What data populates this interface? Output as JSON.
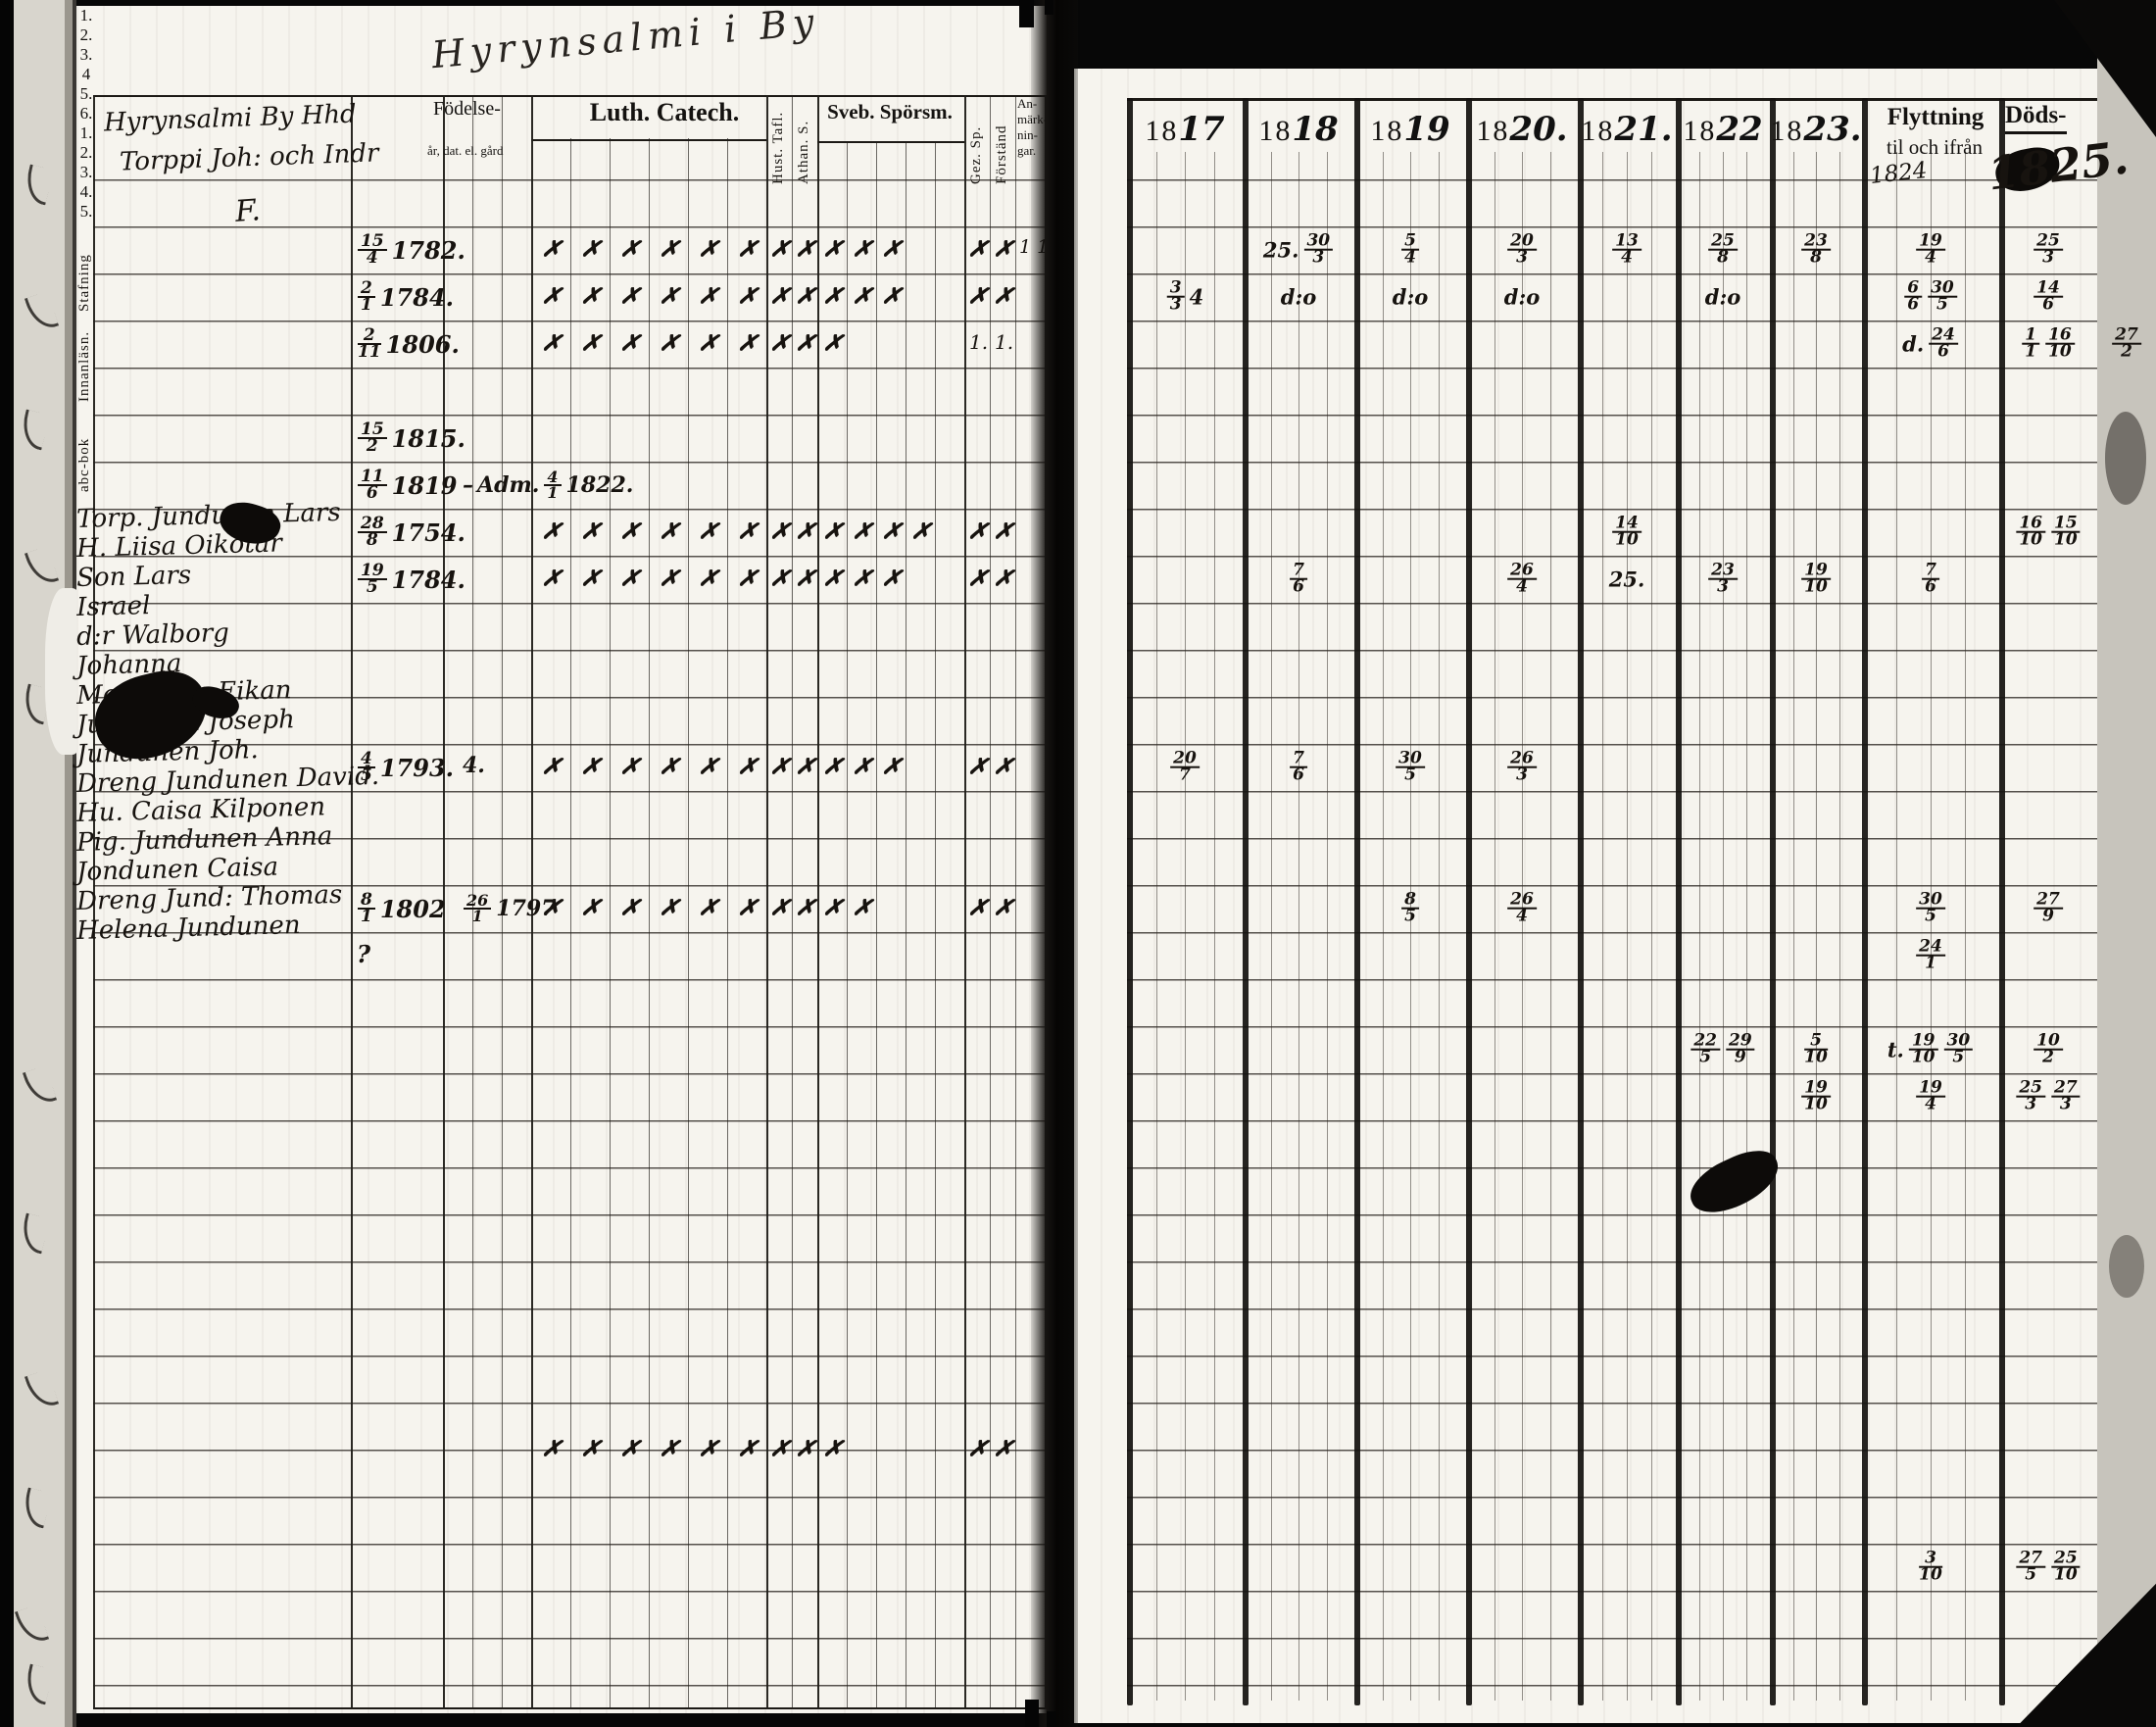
{
  "book_title_script": "Hyrynsalmi i By",
  "left_page": {
    "heading_line1": "Hyrynsalmi By Hhd",
    "heading_line2": "Torppi Joh: och Indr",
    "heading_initial": "F.",
    "header": {
      "birth_label": "Födelse-",
      "birth_sub": "år, dat. el. gård",
      "vertical_cols": [
        {
          "key": "st",
          "label": "Stafning"
        },
        {
          "key": "in",
          "label": "Innanläsn."
        },
        {
          "key": "abc",
          "label": "abc-bok"
        }
      ],
      "luth_label": "Luth. Catech.",
      "luth_numbers": [
        "1.",
        "2.",
        "3.",
        "4",
        "5.",
        "6."
      ],
      "hust_label": "Hust. Tafl.",
      "athan_label": "Athan. S.",
      "sveb_label": "Sveb. Spörsm.",
      "sveb_numbers": [
        "1.",
        "2.",
        "3.",
        "4.",
        "5."
      ],
      "gez_label": "Gez. Sp.",
      "forstand_label": "Förständ",
      "anm_lines": [
        "An-",
        "märk-",
        "nin-",
        "gar."
      ]
    },
    "rows": [
      {
        "row": 1,
        "indent": 0,
        "name": "Torp. Jundunen Lars",
        "birth": "15/4 1782.",
        "marks": [
          "l1",
          "l2",
          "l3",
          "l4",
          "l5",
          "l6",
          "ht",
          "as",
          "s1",
          "s2",
          "s3",
          "gz",
          "fs"
        ],
        "anm": "1 1"
      },
      {
        "row": 2,
        "indent": 0,
        "name": "H. Liisa Oikotar",
        "birth": "2/1 1784.",
        "marks": [
          "l1",
          "l2",
          "l3",
          "l4",
          "l5",
          "l6",
          "ht",
          "as",
          "s1",
          "s2",
          "s3",
          "gz",
          "fs"
        ]
      },
      {
        "row": 3,
        "indent": 70,
        "name": "Son Lars",
        "birth": "2/11 1806.",
        "marks": [
          "l1",
          "l2",
          "l3",
          "l4",
          "l5",
          "l6",
          "ht",
          "as",
          "s1"
        ],
        "texts": {
          "gz": "1.",
          "fs": "1."
        }
      },
      {
        "row": 4,
        "indent": 115,
        "name": "Israel",
        "birth": ""
      },
      {
        "row": 5,
        "indent": 70,
        "name": "d:r Walborg",
        "birth": "15/2 1815."
      },
      {
        "row": 6,
        "indent": 55,
        "name": "Johanna",
        "birth": "11/6 1819",
        "extra": "– Adm. 4/1 1822."
      },
      {
        "row": 7,
        "indent": 10,
        "name": "Mor Carin Eikan",
        "birth": "28/8 1754.",
        "marks": [
          "l1",
          "l2",
          "l3",
          "l4",
          "l5",
          "l6",
          "ht",
          "as",
          "s1",
          "s2",
          "s3",
          "s4",
          "gz",
          "fs"
        ]
      },
      {
        "row": 8,
        "indent": 15,
        "name": "Jundunen Joseph",
        "birth": "19/5 1784.",
        "marks": [
          "l1",
          "l2",
          "l3",
          "l4",
          "l5",
          "l6",
          "ht",
          "as",
          "s1",
          "s2",
          "s3",
          "gz",
          "fs"
        ]
      },
      {
        "row": 12,
        "indent": 25,
        "name": "Jundunen Joh.",
        "birth": "4/5 1793.",
        "extra": "4.",
        "marks": [
          "l1",
          "l2",
          "l3",
          "l4",
          "l5",
          "l6",
          "ht",
          "as",
          "s1",
          "s2",
          "s3",
          "gz",
          "fs"
        ]
      },
      {
        "row": 15,
        "indent": -20,
        "name": "Dreng Jundunen David.",
        "birth": "8/1 1802",
        "extra": "26/1 1797",
        "marks": [
          "l1",
          "l2",
          "l3",
          "l4",
          "l5",
          "l6",
          "ht",
          "as",
          "s1",
          "s2",
          "gz",
          "fs"
        ]
      },
      {
        "row": 16,
        "indent": 30,
        "name": "Hu. Caisa Kilponen",
        "birth": "?"
      },
      {
        "row": 18,
        "indent": -10,
        "name": "Pig. Jundunen Anna",
        "birth": ""
      },
      {
        "row": 19,
        "indent": 60,
        "name": "Jondunen Caisa",
        "birth": ""
      },
      {
        "row": 26.5,
        "indent": 0,
        "name": "Dreng Jund: Thomas",
        "birth": "",
        "marks": [
          "l1",
          "l2",
          "l3",
          "l4",
          "l5",
          "l6",
          "ht",
          "as",
          "s1",
          "gz",
          "fs"
        ]
      },
      {
        "row": 29,
        "indent": 40,
        "name": "Helena Jundunen",
        "birth": ""
      }
    ]
  },
  "right_page": {
    "year_cols": [
      {
        "printed": "18",
        "script": "17"
      },
      {
        "printed": "18",
        "script": "18"
      },
      {
        "printed": "18",
        "script": "19"
      },
      {
        "printed": "18",
        "script": "20."
      },
      {
        "printed": "18",
        "script": "21."
      },
      {
        "printed": "18",
        "script": "22"
      },
      {
        "printed": "18",
        "script": "23."
      }
    ],
    "flytt": {
      "line1": "Flyttning",
      "line2": "til och ifrån",
      "script": "1824"
    },
    "dods": {
      "line1": "Döds-",
      "script": "1825."
    },
    "cells": [
      {
        "row": 1,
        "col": "1818",
        "text": "25. 30/3"
      },
      {
        "row": 1,
        "col": "1819",
        "text": "5/4"
      },
      {
        "row": 1,
        "col": "1820",
        "text": "20/3"
      },
      {
        "row": 1,
        "col": "1821",
        "text": "13/4"
      },
      {
        "row": 1,
        "col": "1822",
        "text": "25/8"
      },
      {
        "row": 1,
        "col": "1823",
        "text": "23/8"
      },
      {
        "row": 1,
        "col": "fl",
        "text": "19/4."
      },
      {
        "row": 1,
        "col": "dd",
        "text": "25/3"
      },
      {
        "row": 2,
        "col": "1817",
        "text": "3/3 4"
      },
      {
        "row": 2,
        "col": "1818",
        "text": "d:o"
      },
      {
        "row": 2,
        "col": "1819",
        "text": "d:o"
      },
      {
        "row": 2,
        "col": "1820",
        "text": "d:o"
      },
      {
        "row": 2,
        "col": "1822",
        "text": "d:o"
      },
      {
        "row": 2,
        "col": "fl",
        "text": "6/6 30/5"
      },
      {
        "row": 2,
        "col": "dd",
        "text": "14/6"
      },
      {
        "row": 3,
        "col": "fl",
        "text": "d. 24/6"
      },
      {
        "row": 3,
        "col": "dd",
        "text": "1/1 16/10"
      },
      {
        "row": 3,
        "col": "mg",
        "text": "27/2"
      },
      {
        "row": 7,
        "col": "1821",
        "text": "14/10"
      },
      {
        "row": 7,
        "col": "dd",
        "text": "16/10 15/10"
      },
      {
        "row": 8,
        "col": "1818",
        "text": "7/6"
      },
      {
        "row": 8,
        "col": "1820",
        "text": "26/4"
      },
      {
        "row": 8,
        "col": "1821",
        "text": "25."
      },
      {
        "row": 8,
        "col": "1822",
        "text": "23/3"
      },
      {
        "row": 8,
        "col": "1823",
        "text": "19/10"
      },
      {
        "row": 8,
        "col": "fl",
        "text": "7/6"
      },
      {
        "row": 12,
        "col": "1817",
        "text": "20/7"
      },
      {
        "row": 12,
        "col": "1818",
        "text": "7/6"
      },
      {
        "row": 12,
        "col": "1819",
        "text": "30/5"
      },
      {
        "row": 12,
        "col": "1820",
        "text": "26/3"
      },
      {
        "row": 15,
        "col": "1819",
        "text": "8/5"
      },
      {
        "row": 15,
        "col": "1820",
        "text": "26/4"
      },
      {
        "row": 15,
        "col": "fl",
        "text": "30/5"
      },
      {
        "row": 15,
        "col": "dd",
        "text": "27/9"
      },
      {
        "row": 16,
        "col": "fl",
        "text": "24/1."
      },
      {
        "row": 18,
        "col": "1822",
        "text": "22/5 29/9"
      },
      {
        "row": 18,
        "col": "1823",
        "text": "5/10"
      },
      {
        "row": 18,
        "col": "fl",
        "text": "t. 19/10 30/5"
      },
      {
        "row": 18,
        "col": "dd",
        "text": "10/2"
      },
      {
        "row": 19,
        "col": "1823",
        "text": "19/10"
      },
      {
        "row": 19,
        "col": "fl",
        "text": "19/4"
      },
      {
        "row": 19,
        "col": "dd",
        "text": "25/3 27/3"
      },
      {
        "row": 29,
        "col": "fl",
        "text": "3/10"
      },
      {
        "row": 29,
        "col": "dd",
        "text": "27/5 25/10"
      }
    ]
  },
  "colors": {
    "page": "#f6f4ee",
    "ink": "#17130f",
    "line": "#1c1915",
    "edge": "#070707"
  }
}
